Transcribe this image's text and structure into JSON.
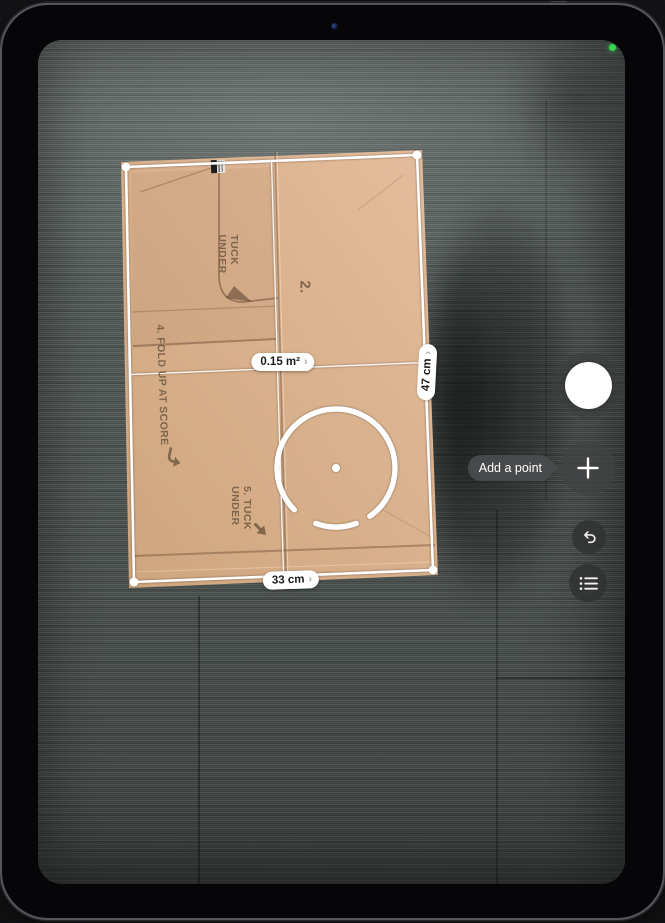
{
  "app": {
    "name": "Measure camera view"
  },
  "camera": {
    "indicator": "camera-active-dot",
    "indicator_color": "#32d74b"
  },
  "measurements": {
    "area": "0.15 m²",
    "side_width": "33 cm",
    "side_height": "47 cm",
    "detail_chevron": "›"
  },
  "tooltip": {
    "add_point": "Add a point"
  },
  "controls": {
    "shutter": {
      "icon": "shutter-circle"
    },
    "add_point": {
      "icon": "plus-icon"
    },
    "undo": {
      "icon": "undo-arrow-icon"
    },
    "measurement_list": {
      "icon": "list-icon"
    }
  },
  "box_print": {
    "tuck_line1": "TUCK",
    "tuck_line2": "UNDER",
    "panel_number": "2.",
    "instruction_fold": "4. FOLD UP AT SCORE",
    "instruction_tuck_line1": "5. TUCK",
    "instruction_tuck_line2": "UNDER"
  },
  "colors": {
    "accent_green": "#32d74b",
    "pill_background": "#ffffff",
    "pill_text": "#1c1c1e",
    "hud_button_background": "#3b3b3d",
    "tooltip_background": "#4a4b4d",
    "cardboard": "#d9b18e",
    "overlay_white": "#ffffff"
  }
}
